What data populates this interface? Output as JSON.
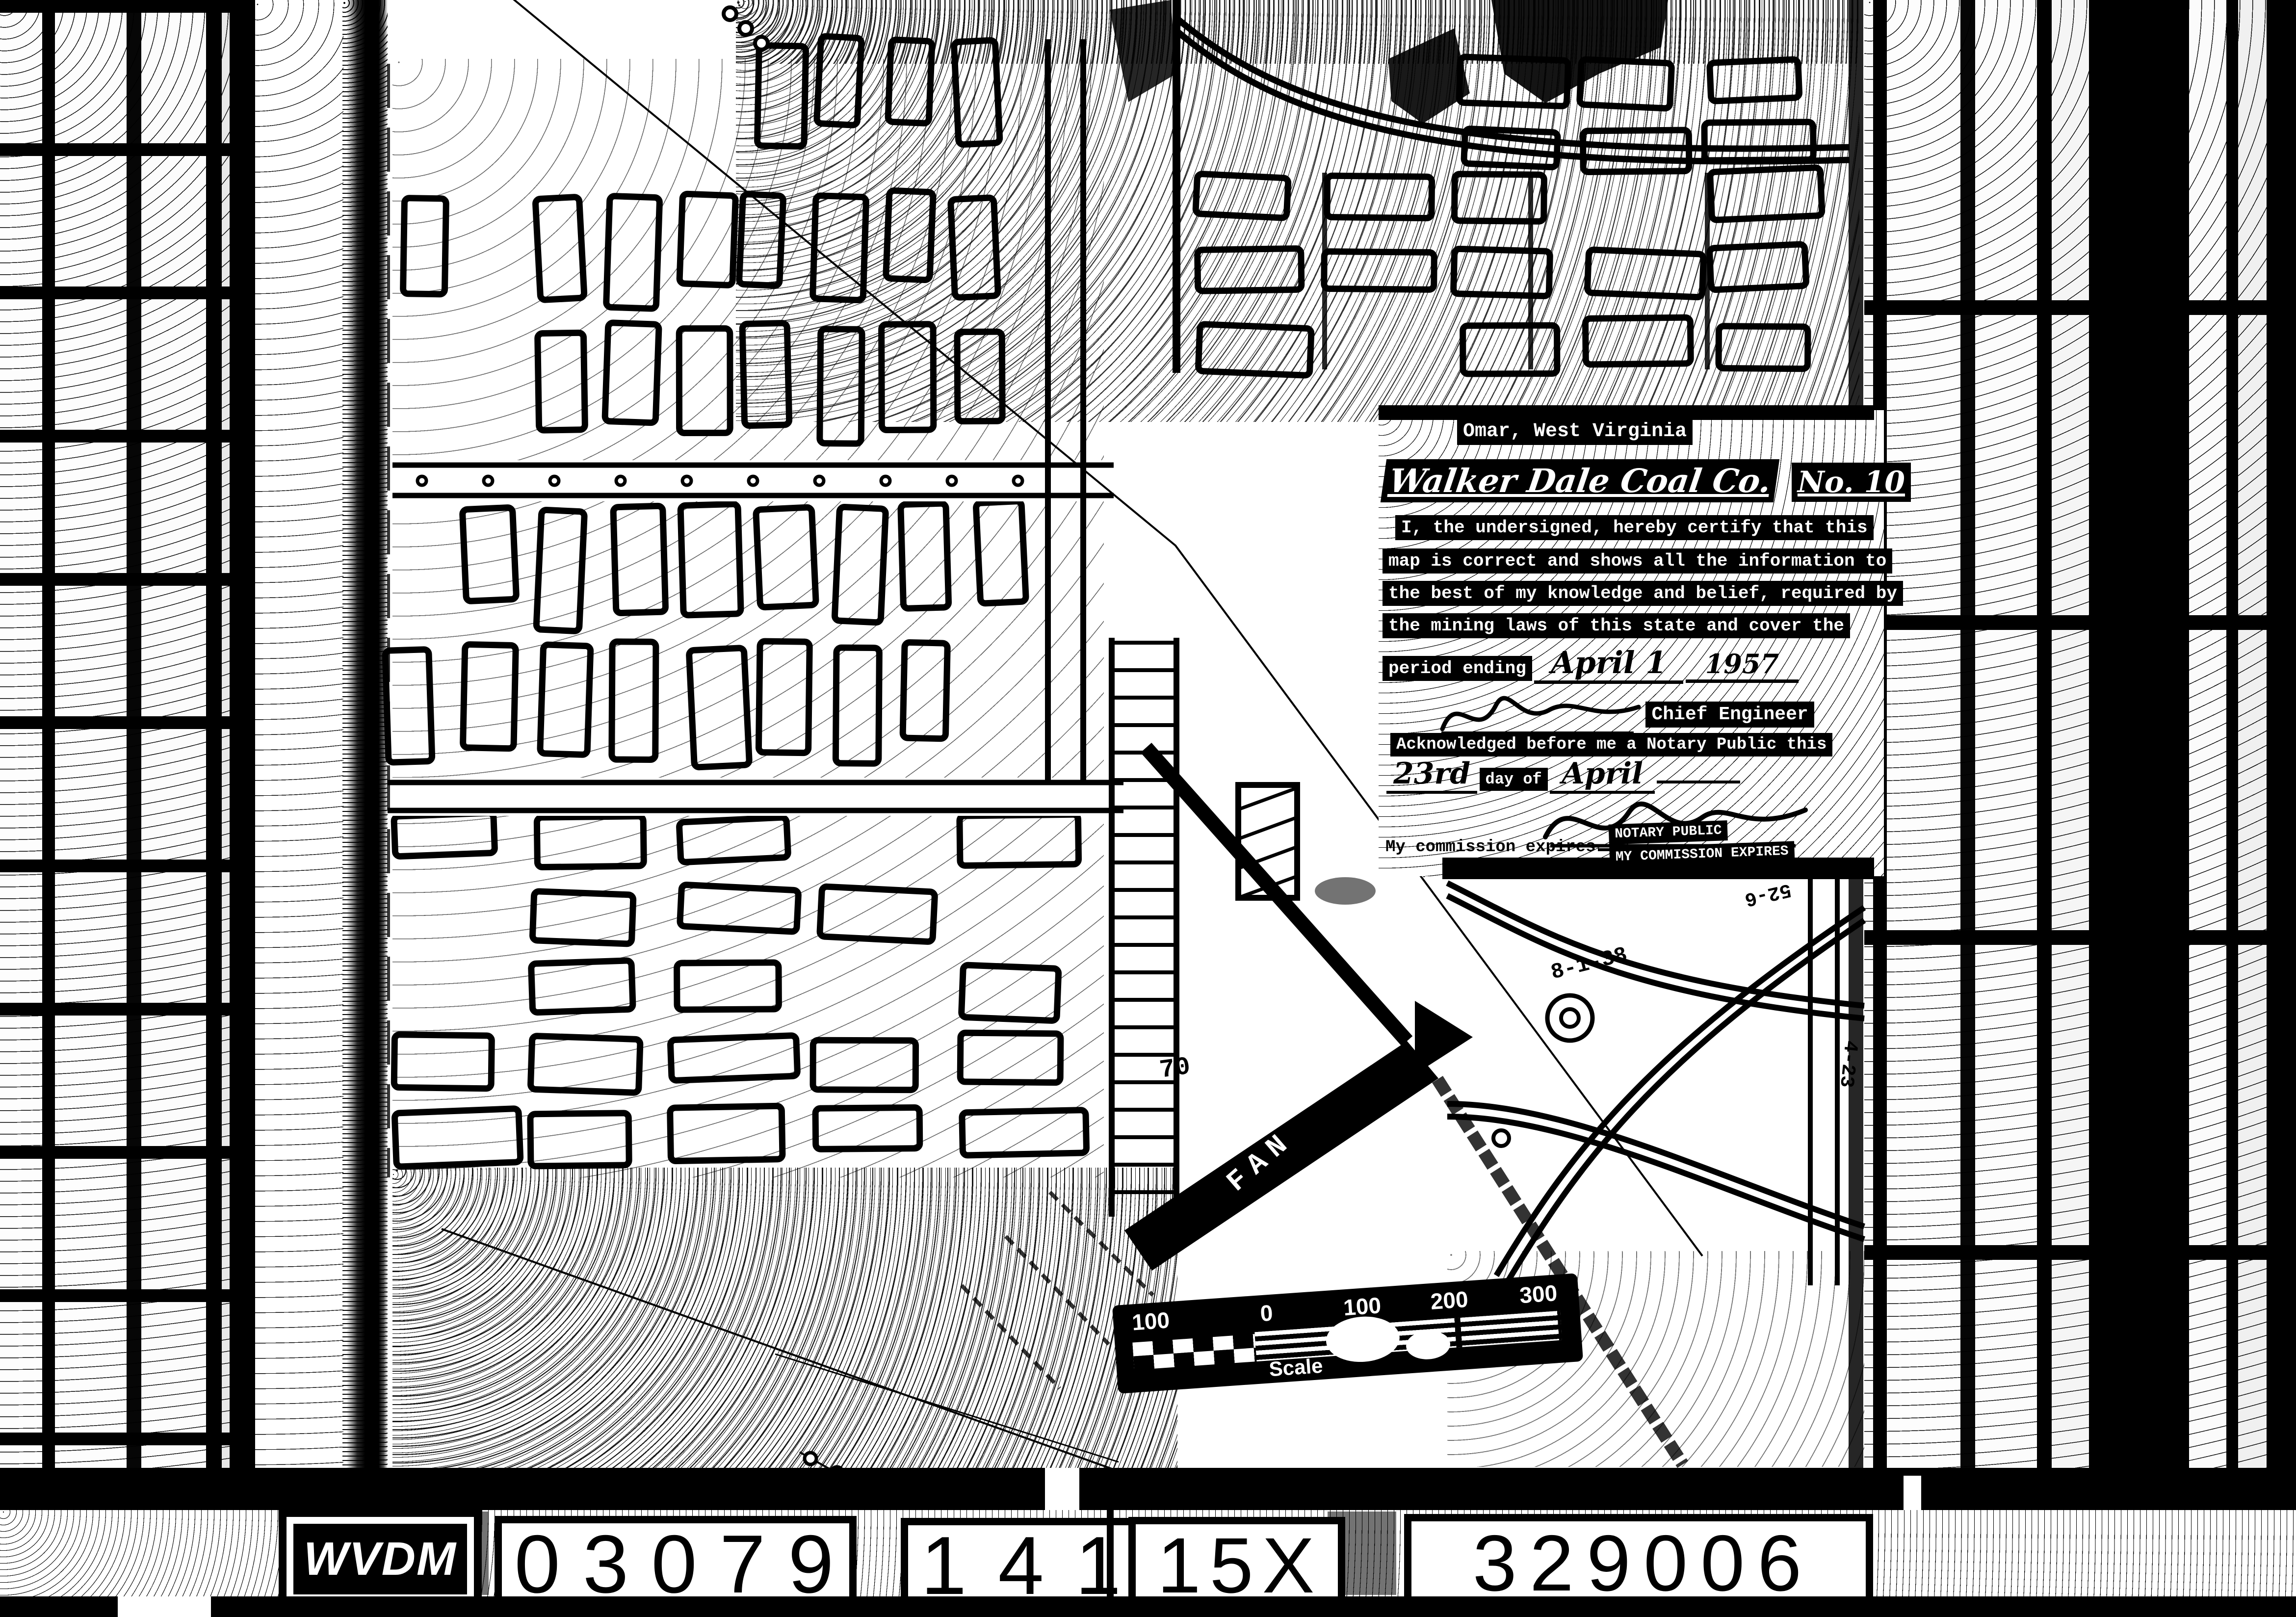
{
  "certificate": {
    "location_line": "Omar, West Virginia",
    "company_line": "Walker Dale Coal Co.",
    "company_no": "No. 10",
    "body_line1": "I, the undersigned, hereby certify that this",
    "body_line2": "map is correct and shows all the information to",
    "body_line3": "the best of my knowledge and belief, required by",
    "body_line4": "the mining laws of this state and cover the",
    "period_label": "period ending",
    "period_date": "April 1",
    "period_year": "1957",
    "signature_title": "Chief Engineer",
    "ack_line": "Acknowledged before me a Notary Public this",
    "day_value": "23rd",
    "day_label": "day of",
    "month_value": "April",
    "stamp_line1": "NOTARY PUBLIC",
    "stamp_line2": "MY COMMISSION EXPIRES",
    "commission_label": "My commission expires"
  },
  "scale_bar": {
    "ticks": [
      "100",
      "0",
      "100",
      "200",
      "300"
    ],
    "caption": "Scale"
  },
  "annotations": {
    "fan": "FAN",
    "d1": "8-1-38",
    "d2": "10-20-28",
    "d3": "52-6",
    "d4": "4-23",
    "n70": "70"
  },
  "film_strip": {
    "prefix": "WVDM",
    "code1": "03079",
    "code2": "141",
    "code3": "15X",
    "code4": "329006"
  },
  "colors": {
    "ink": "#000000",
    "paper": "#ffffff"
  }
}
